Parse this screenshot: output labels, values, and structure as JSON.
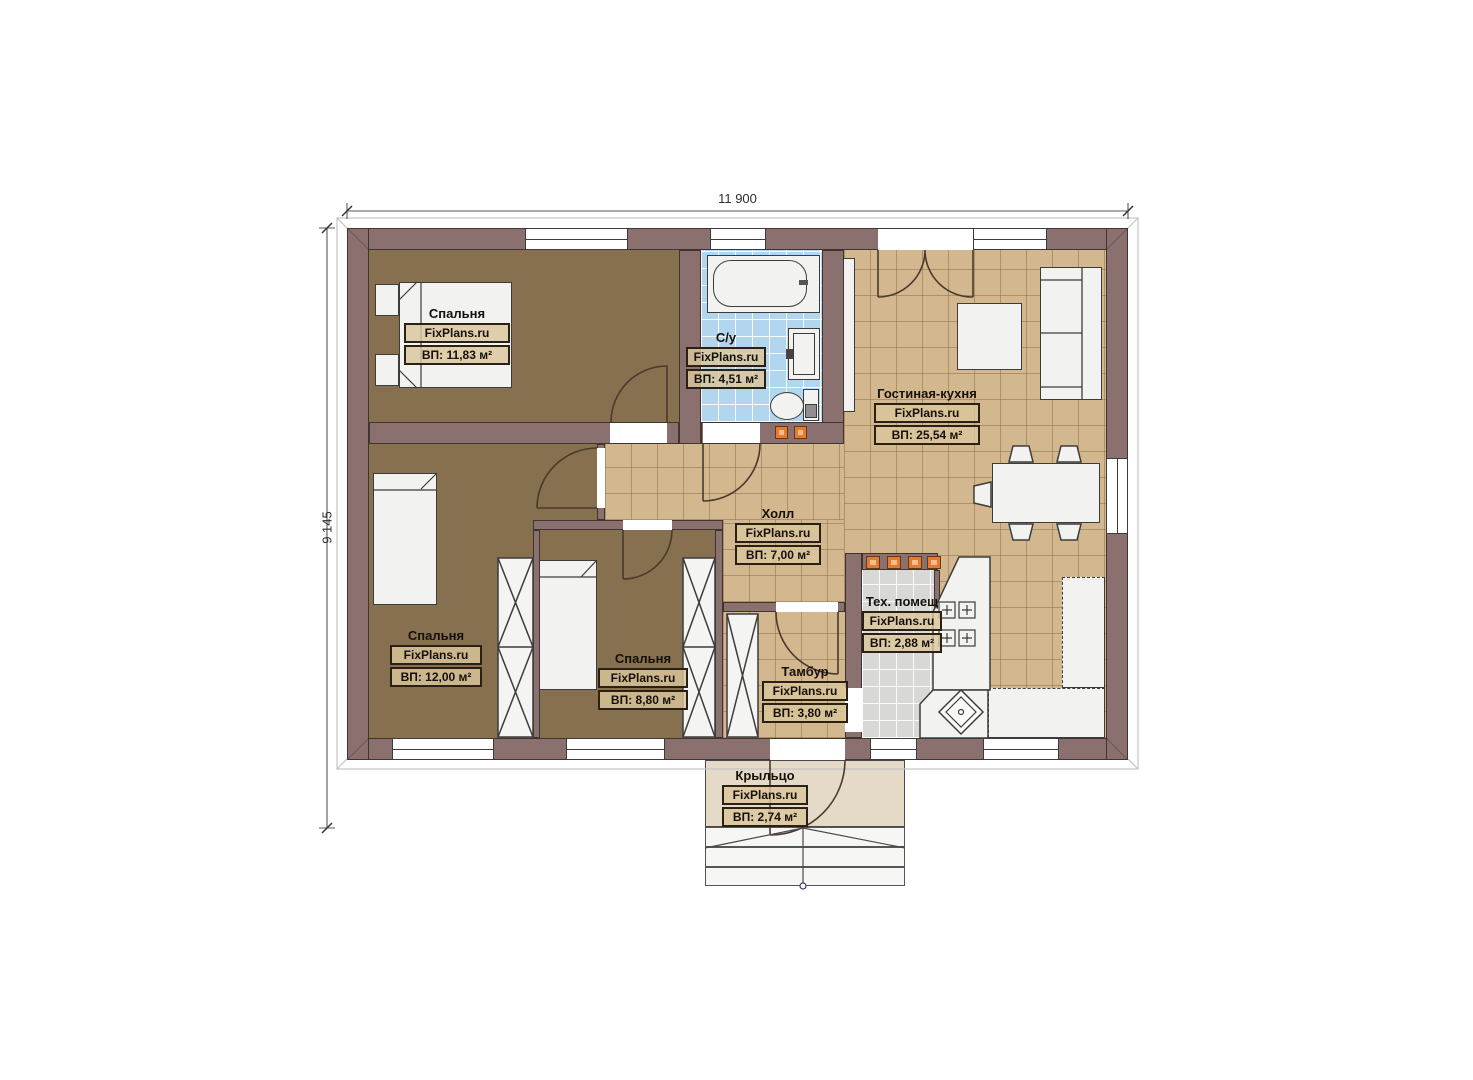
{
  "title": "Floor plan — one-storey house",
  "watermark": "FixPlans.ru",
  "dims": {
    "width": "11 900",
    "height": "9 145"
  },
  "rooms": {
    "bedroom1": {
      "name": "Спальня",
      "area": "ВП: 11,83 м²"
    },
    "bathroom": {
      "name": "С/у",
      "area": "ВП: 4,51 м²"
    },
    "living": {
      "name": "Гостиная-кухня",
      "area": "ВП: 25,54 м²"
    },
    "hall": {
      "name": "Холл",
      "area": "ВП: 7,00 м²"
    },
    "bedroom2": {
      "name": "Спальня",
      "area": "ВП: 12,00 м²"
    },
    "bedroom3": {
      "name": "Спальня",
      "area": "ВП: 8,80 м²"
    },
    "tambour": {
      "name": "Тамбур",
      "area": "ВП: 3,80 м²"
    },
    "tech": {
      "name": "Тех. помещ",
      "area": "ВП: 2,88 м²"
    },
    "porch": {
      "name": "Крыльцо",
      "area": "ВП: 2,74 м²"
    }
  },
  "colors": {
    "wall": "#8b7070",
    "wood_floor": "#867050",
    "tile_tan": "#d3b78e",
    "tile_blue": "#b3d6ef",
    "tile_gray": "#d8d8d6",
    "porch": "#e5d9c7",
    "vent_orange": "#e87a30"
  }
}
